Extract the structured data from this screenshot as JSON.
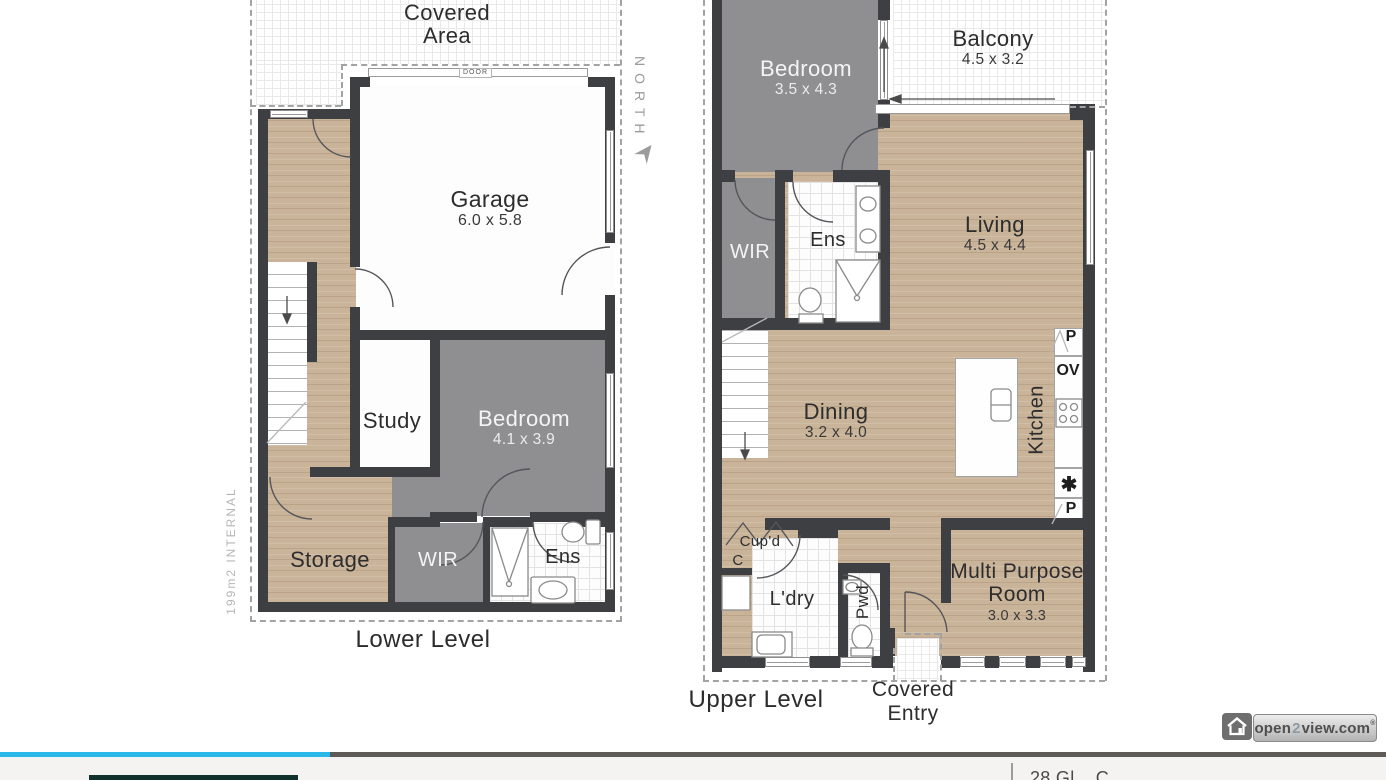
{
  "lower_level": {
    "title": "Lower Level",
    "area_note": "199m2 INTERNAL",
    "covered_area": {
      "line1": "Covered",
      "line2": "Area"
    },
    "garage_door_label": "DOOR",
    "rooms": {
      "garage": {
        "name": "Garage",
        "dims": "6.0 x 5.8"
      },
      "study": {
        "name": "Study"
      },
      "bedroom": {
        "name": "Bedroom",
        "dims": "4.1 x 3.9"
      },
      "storage": {
        "name": "Storage"
      },
      "wir": {
        "name": "WIR"
      },
      "ens": {
        "name": "Ens"
      }
    }
  },
  "upper_level": {
    "title": "Upper Level",
    "covered_entry": {
      "line1": "Covered",
      "line2": "Entry"
    },
    "rooms": {
      "bedroom": {
        "name": "Bedroom",
        "dims": "3.5 x 4.3"
      },
      "balcony": {
        "name": "Balcony",
        "dims": "4.5 x 3.2"
      },
      "wir": {
        "name": "WIR"
      },
      "ens": {
        "name": "Ens"
      },
      "living": {
        "name": "Living",
        "dims": "4.5 x 4.4"
      },
      "dining": {
        "name": "Dining",
        "dims": "3.2 x 4.0"
      },
      "kitchen": {
        "name": "Kitchen"
      },
      "cupboard": {
        "name": "Cup'd"
      },
      "closet": {
        "name": "C"
      },
      "laundry": {
        "name": "L'dry"
      },
      "powder": {
        "name": "Pwd"
      },
      "multi_purpose": {
        "line1": "Multi Purpose",
        "line2": "Room",
        "dims": "3.0 x 3.3"
      }
    },
    "kitchen_labels": {
      "pantry_top": "P",
      "oven": "OV",
      "cooktop_symbol": "✱",
      "pantry_bottom": "P"
    }
  },
  "compass": {
    "label": "NORTH"
  },
  "watermark": {
    "prefix": "open",
    "two": "2",
    "suffix": "view.com",
    "registered": "®"
  },
  "footer": {
    "address_partial": "28 Gl... C..."
  },
  "colors": {
    "wall": "#3e3f42",
    "wood": "#c9b399",
    "room_gray": "#8f8f91",
    "accent_cyan": "#29b8e8",
    "bar_gray": "#5e5a57",
    "brand_teal": "#11312c"
  }
}
